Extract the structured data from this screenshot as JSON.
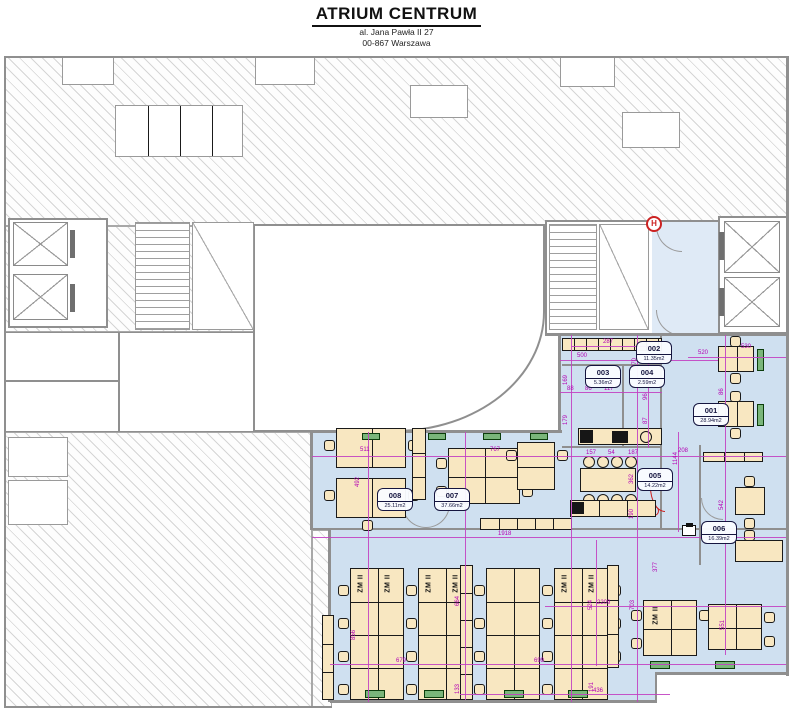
{
  "header": {
    "title": "ATRIUM CENTRUM",
    "address1": "al. Jana Pawła II 27",
    "address2": "00-867 Warszawa"
  },
  "colors": {
    "lease_highlight": "#cfe0f0",
    "dimension_magenta": "#b300b3",
    "convector_green": "#2e7d32",
    "alert_red": "#cc2222"
  },
  "plan": {
    "desk_label": "ZM II",
    "hydrant_symbol": "H",
    "rooms": [
      {
        "number": "001",
        "area": "28.94m2"
      },
      {
        "number": "002",
        "area": "11.35m2"
      },
      {
        "number": "003",
        "area": "5.36m2"
      },
      {
        "number": "004",
        "area": "2.59m2"
      },
      {
        "number": "005",
        "area": "14.22m2"
      },
      {
        "number": "006",
        "area": "16.39m2"
      },
      {
        "number": "007",
        "area": "37.66m2"
      },
      {
        "number": "008",
        "area": "25.11m2"
      }
    ],
    "dims": [
      "287",
      "500",
      "520",
      "530",
      "270",
      "169",
      "179",
      "88",
      "86",
      "117",
      "96",
      "87",
      "511",
      "767",
      "157",
      "54",
      "187",
      "208",
      "1144",
      "492",
      "362",
      "190",
      "86",
      "542",
      "302",
      "1918",
      "2209",
      "524",
      "703",
      "551",
      "856",
      "664",
      "679",
      "699",
      "133",
      "191",
      "436",
      "377"
    ]
  }
}
